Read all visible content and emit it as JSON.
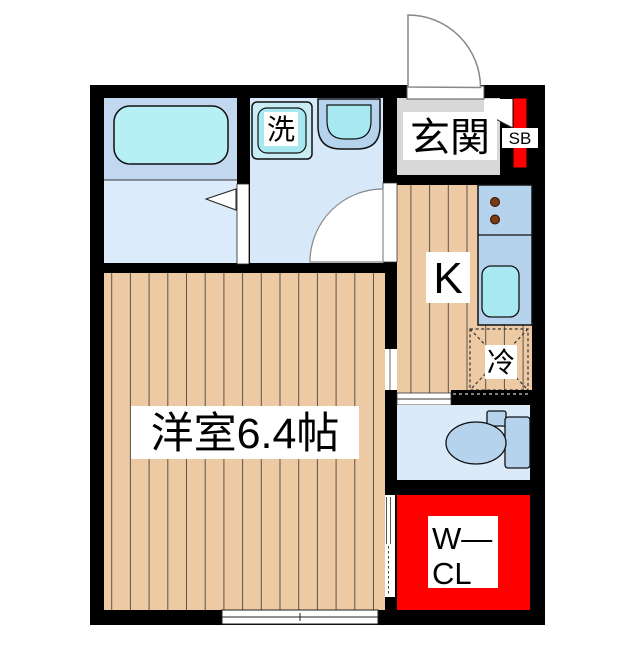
{
  "labels": {
    "entrance": "玄関",
    "shoe_box": "SB",
    "washing_machine": "洗",
    "kitchen": "K",
    "refrigerator": "冷",
    "main_room": "洋室6.4帖",
    "closet_line1": "W—",
    "closet_line2": "CL"
  },
  "colors": {
    "wall": "#000000",
    "plank": "#edcaa3",
    "plank_line": "#5a544c",
    "bath_upper": "#c2d8f0",
    "bath_lower": "#dcebfa",
    "washroom": "#d7e8f8",
    "toilet_room": "#dbeaf8",
    "fixture": "#b6d3ee",
    "cyan": "#a8e8f1",
    "cyan_light": "#b6f0f4",
    "washer_outer": "#c8edf4",
    "genkan_gray": "#d8d8d8",
    "red": "#ff0000",
    "burner_brown": "#7b3a12"
  }
}
